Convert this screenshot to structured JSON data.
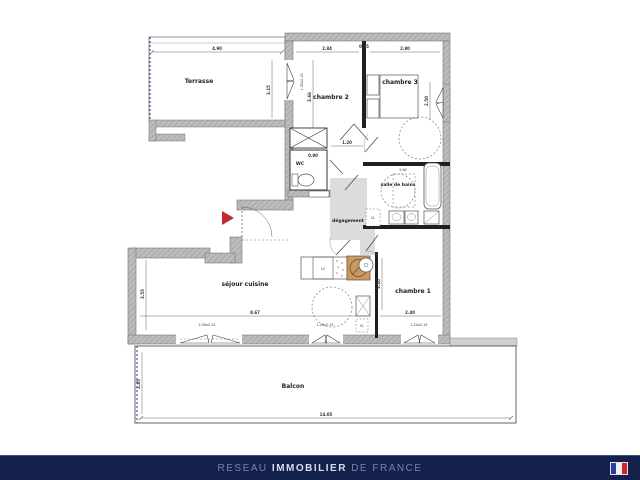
{
  "footer": {
    "brand_prefix": "RESEAU ",
    "brand_bold": "IMMOBILIER",
    "brand_suffix": " DE FRANCE",
    "bar_color": "#15214d",
    "text_muted_color": "#79839f",
    "text_bright_color": "#d9dde9",
    "flag_icon": "french-flag-icon",
    "flag_colors": {
      "blue": "#2b3f9b",
      "white": "#f2f2f2",
      "red": "#cf2433"
    }
  },
  "plan": {
    "labels": {
      "terrasse": "Terrasse",
      "chambre2": "chambre 2",
      "chambre3": "chambre 3",
      "wc": "WC",
      "salle_de_bains": "salle de bains",
      "degagement": "dégagement",
      "sejour_cuisine": "séjour cuisine",
      "chambre1": "chambre 1",
      "balcon": "Balcon",
      "closet": "CL",
      "closet2": "CL",
      "dishwasher": "LV"
    },
    "dims": {
      "terrasse_w": "4.90",
      "terrasse_h": "3.15",
      "chambre2_w": "2.84",
      "wall_gap": "0.95",
      "chambre3_w": "2.80",
      "chambre2_h": "3.66",
      "chambre3_h": "2.50",
      "hall_w": "1.20",
      "wc_w": "0.90",
      "sdb_w": "2.60",
      "sejour_w": "8.67",
      "sejour_h": "3.55",
      "chambre1_w": "2.40",
      "chambre1_h": "3.10",
      "balcon_w": "14.05",
      "balcon_h": "2.85",
      "win_sejour_left": "2.40x2.15",
      "win_sejour_mid": "1.20x2.15",
      "win_chambre1": "1.20x2.15",
      "win_chambre2": "1.35x2.15"
    },
    "colors": {
      "wall_gray": "#b5b5b5",
      "wall_black": "#1f1f1f",
      "dashed_blue": "#4553b4",
      "entrance_arrow_red": "#c32b2b",
      "hob_tan": "#c79a62",
      "corridor_gray": "#dcdcdc"
    }
  }
}
